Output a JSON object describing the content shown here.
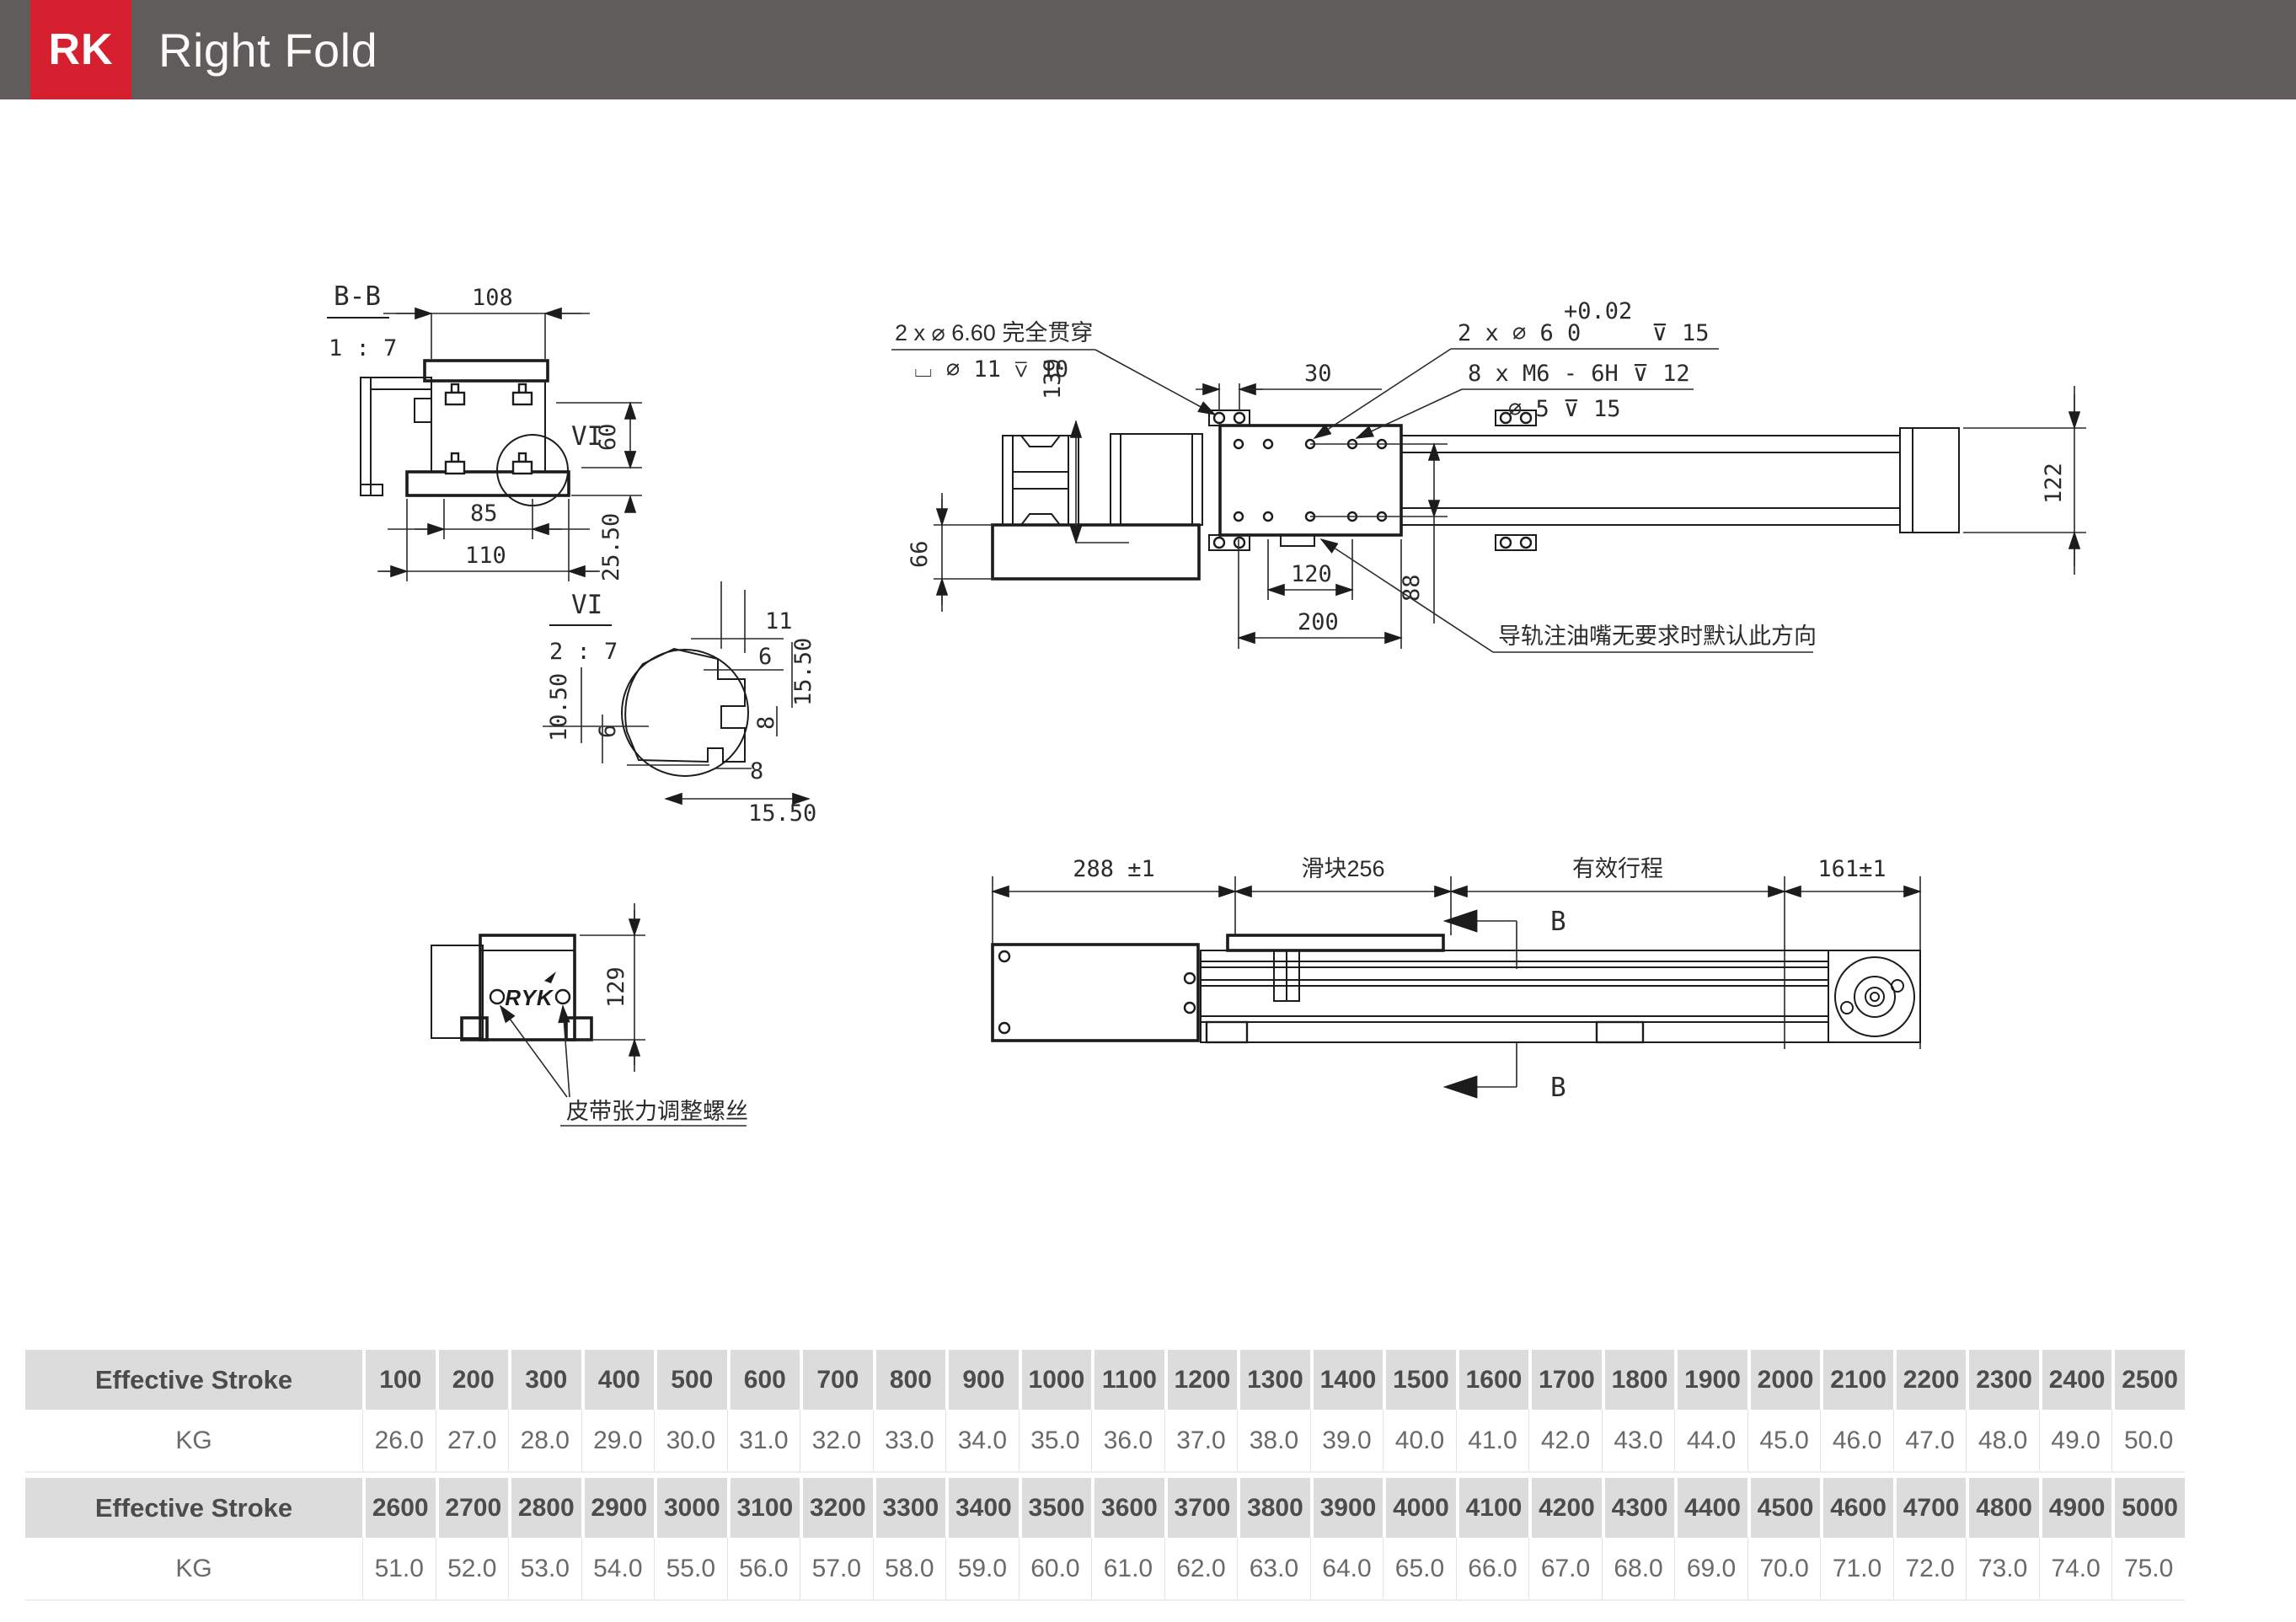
{
  "header": {
    "logo": "RK",
    "title": "Right Fold"
  },
  "colors": {
    "accent_red": "#d6202f",
    "header_gray": "#615c5c",
    "table_header_bg": "#dcdcdc"
  },
  "views": {
    "section_bb": {
      "label": "B-B",
      "scale": "1 : 7",
      "dim_108": "108",
      "dim_85": "85",
      "dim_110": "110",
      "dim_60": "60",
      "dim_25_50": "25.50",
      "detail_ref": "VI"
    },
    "detail_vi": {
      "label": "VI",
      "scale": "2 : 7",
      "dim_11": "11",
      "dim_6a": "6",
      "dim_15_50a": "15.50",
      "dim_8a": "8",
      "dim_10_50": "10.50",
      "dim_6b": "6",
      "dim_8b": "8",
      "dim_15_50b": "15.50"
    },
    "motor_end": {
      "brand": "RYK",
      "dim_129": "129",
      "note_belt_tension": "皮带张力调整螺丝"
    },
    "plan": {
      "callout_through_holes_line1": "2 x ⌀ 6.60 完全贯穿",
      "callout_through_holes_line2": "⌴  ⌀ 11  ⊽ 10",
      "callout_dowel_tolerance": "+0.02",
      "callout_dowel": "2 x ⌀ 6  0",
      "callout_dowel_depth": "⊽ 15",
      "callout_tapped": "8 x M6 - 6H ⊽ 12",
      "callout_tapped_pilot": "⌀ 5 ⊽ 15",
      "note_oil_nozzle": "导轨注油嘴无要求时默认此方向",
      "dim_30": "30",
      "dim_139": "139",
      "dim_66": "66",
      "dim_120": "120",
      "dim_200": "200",
      "dim_88": "88",
      "dim_122": "122"
    },
    "side": {
      "dim_288": "288 ±1",
      "dim_slider": "滑块256",
      "dim_stroke": "有效行程",
      "dim_161": "161±1",
      "section_b_top": "B",
      "section_b_bottom": "B"
    }
  },
  "table": {
    "row1_header": {
      "label": "Effective Stroke",
      "values": [
        "100",
        "200",
        "300",
        "400",
        "500",
        "600",
        "700",
        "800",
        "900",
        "1000",
        "1100",
        "1200",
        "1300",
        "1400",
        "1500",
        "1600",
        "1700",
        "1800",
        "1900",
        "2000",
        "2100",
        "2200",
        "2300",
        "2400",
        "2500"
      ]
    },
    "row1_kg": {
      "label": "KG",
      "values": [
        "26.0",
        "27.0",
        "28.0",
        "29.0",
        "30.0",
        "31.0",
        "32.0",
        "33.0",
        "34.0",
        "35.0",
        "36.0",
        "37.0",
        "38.0",
        "39.0",
        "40.0",
        "41.0",
        "42.0",
        "43.0",
        "44.0",
        "45.0",
        "46.0",
        "47.0",
        "48.0",
        "49.0",
        "50.0"
      ]
    },
    "row2_header": {
      "label": "Effective Stroke",
      "values": [
        "2600",
        "2700",
        "2800",
        "2900",
        "3000",
        "3100",
        "3200",
        "3300",
        "3400",
        "3500",
        "3600",
        "3700",
        "3800",
        "3900",
        "4000",
        "4100",
        "4200",
        "4300",
        "4400",
        "4500",
        "4600",
        "4700",
        "4800",
        "4900",
        "5000"
      ]
    },
    "row2_kg": {
      "label": "KG",
      "values": [
        "51.0",
        "52.0",
        "53.0",
        "54.0",
        "55.0",
        "56.0",
        "57.0",
        "58.0",
        "59.0",
        "60.0",
        "61.0",
        "62.0",
        "63.0",
        "64.0",
        "65.0",
        "66.0",
        "67.0",
        "68.0",
        "69.0",
        "70.0",
        "71.0",
        "72.0",
        "73.0",
        "74.0",
        "75.0"
      ]
    }
  }
}
